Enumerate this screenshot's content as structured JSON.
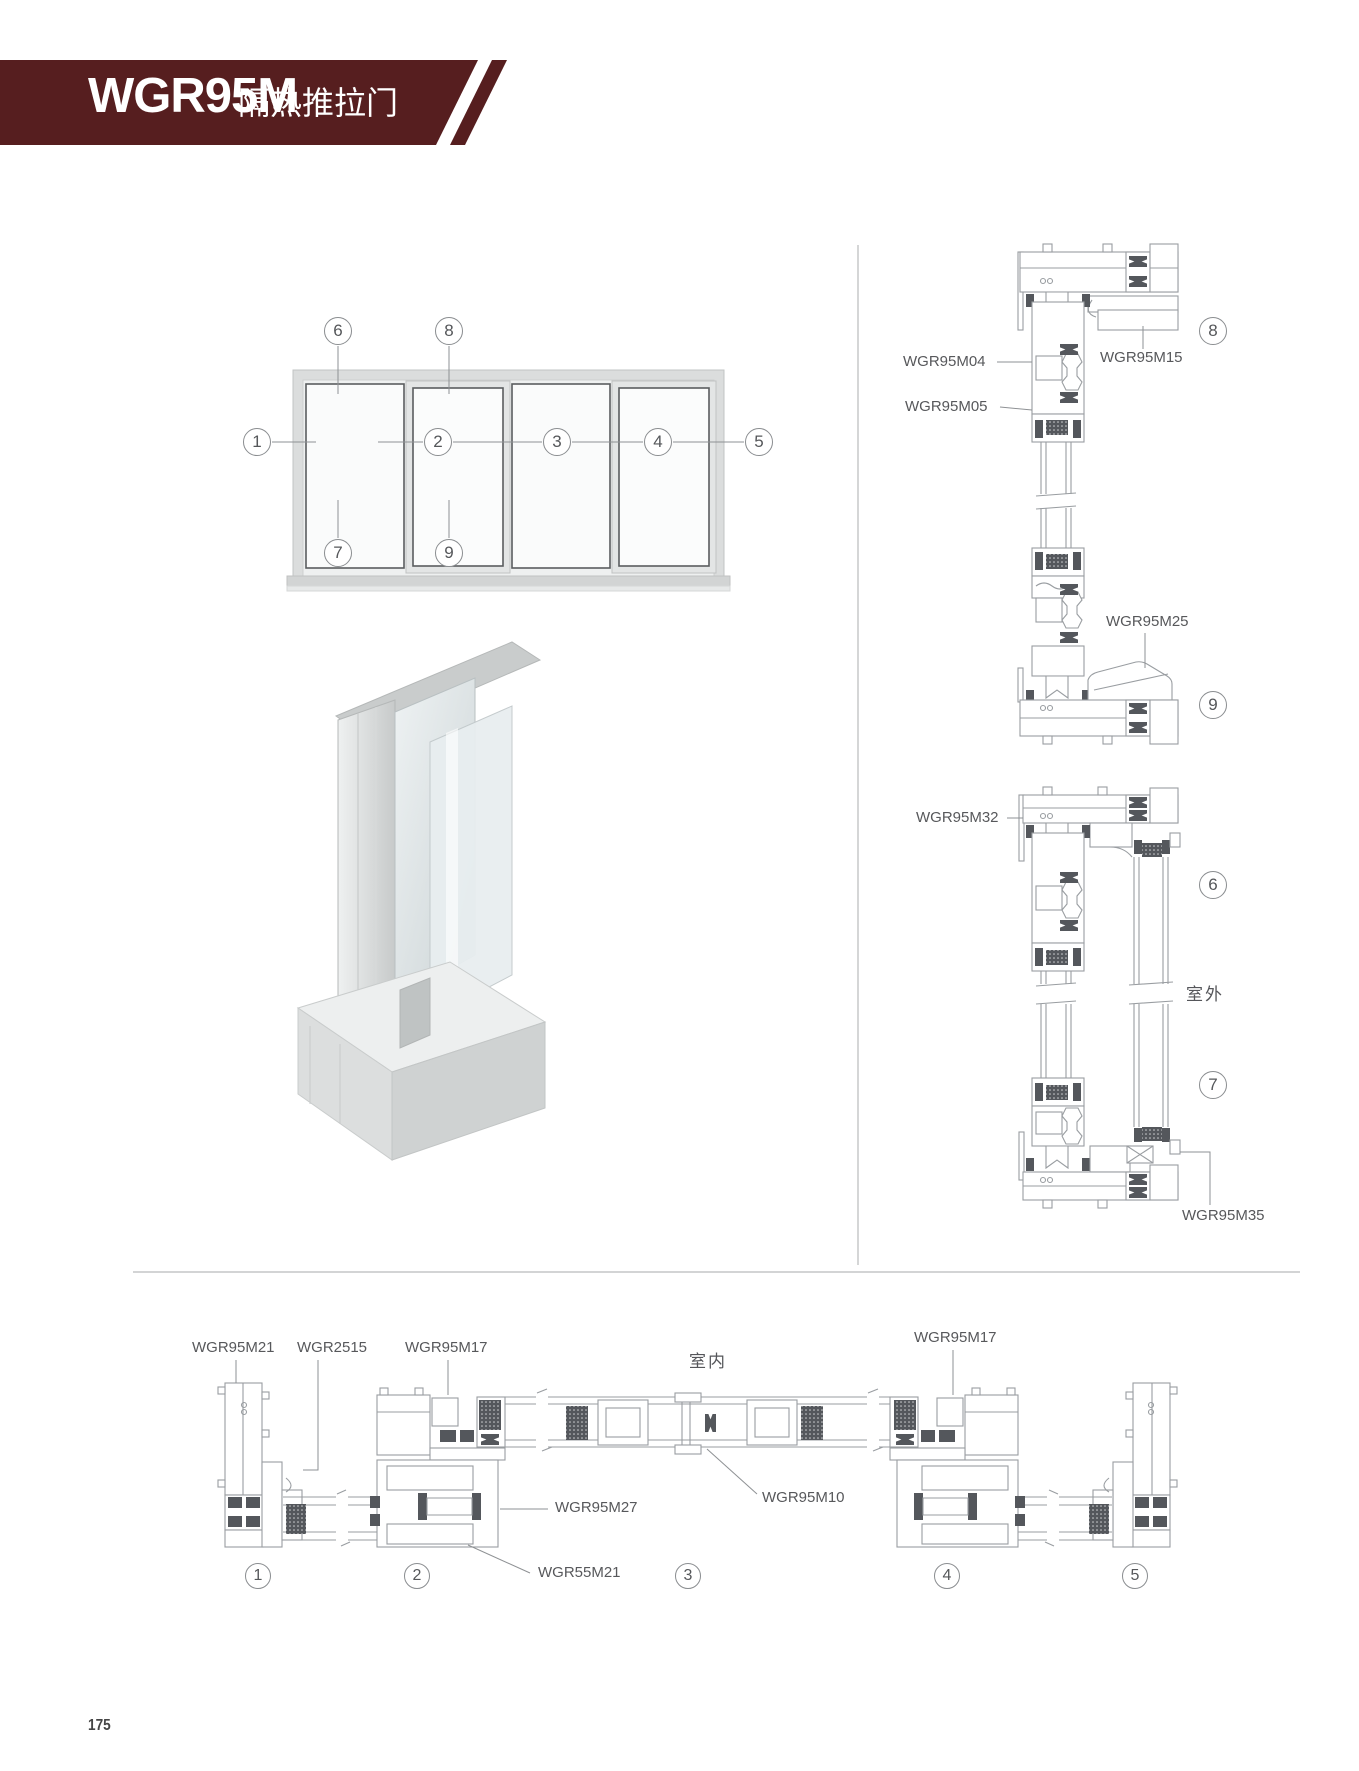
{
  "header": {
    "model": "WGR95M",
    "name": "隔热推拉门"
  },
  "elevation": {
    "top": [
      "6",
      "8"
    ],
    "mid": [
      "1",
      "2",
      "3",
      "4",
      "5"
    ],
    "bottom": [
      "7",
      "9"
    ]
  },
  "sections_right": {
    "head": {
      "m04": "WGR95M04",
      "m05": "WGR95M05",
      "m15": "WGR95M15",
      "callout": "8"
    },
    "sill": {
      "m25": "WGR95M25",
      "callout": "9"
    },
    "jamb": {
      "m32": "WGR95M32",
      "m35": "WGR95M35",
      "callout_top": "6",
      "callout_bottom": "7",
      "outdoor": "室外"
    }
  },
  "plan_section": {
    "indoor": "室内",
    "m21": "WGR95M21",
    "g2515": "WGR2515",
    "m17_left": "WGR95M17",
    "m17_right": "WGR95M17",
    "m27": "WGR95M27",
    "m55": "WGR55M21",
    "m10": "WGR95M10",
    "callouts": [
      "1",
      "2",
      "3",
      "4",
      "5"
    ]
  },
  "page_number": "175",
  "colors": {
    "banner": "#561e1f",
    "line": "#999da1",
    "dark_detail": "#54575c",
    "label": "#57585b"
  }
}
